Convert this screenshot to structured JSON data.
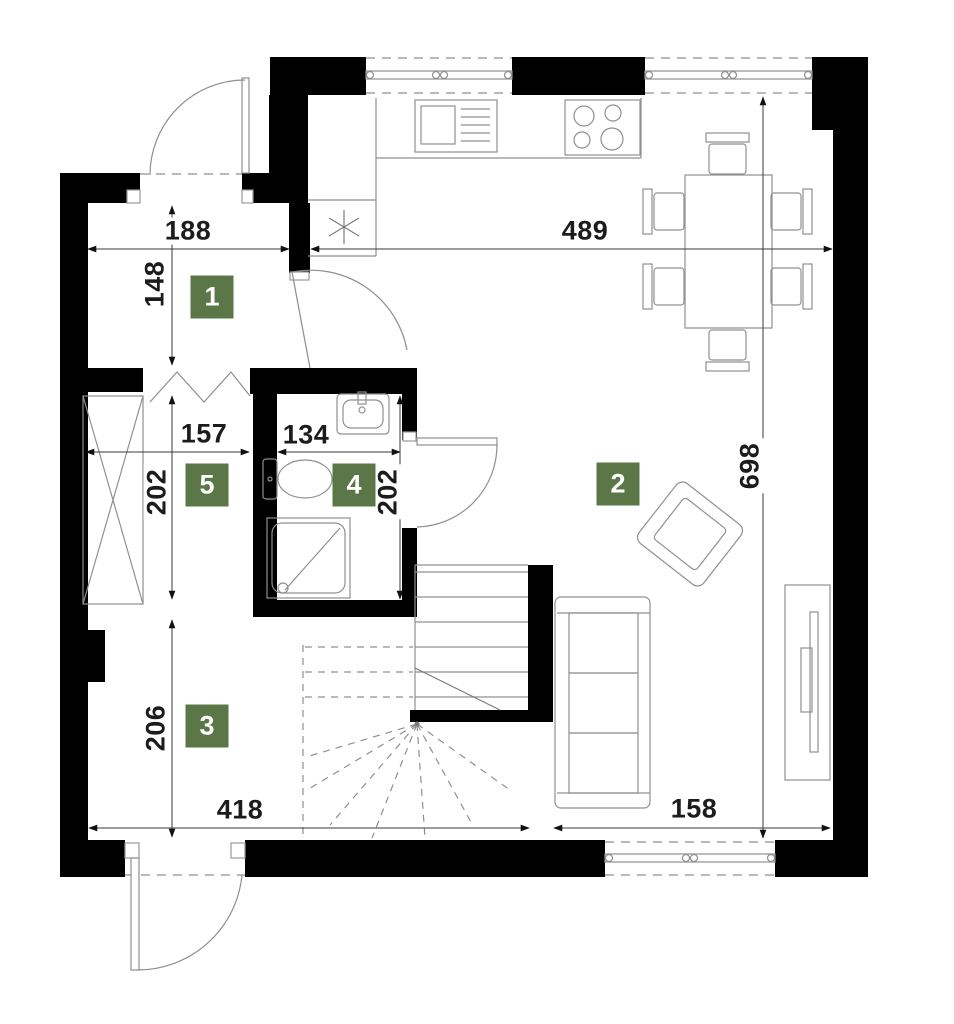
{
  "plan": {
    "type": "apartment-floor-plan",
    "colors": {
      "background": "#ffffff",
      "wall": "#000000",
      "furniture_line": "#909090",
      "dimension_line": "#3a3a3a",
      "dimension_text": "#1c1c1c",
      "badge_bg": "#5b7747",
      "badge_text": "#ffffff"
    },
    "rooms": [
      {
        "id": "room-1",
        "label": "1"
      },
      {
        "id": "room-2",
        "label": "2"
      },
      {
        "id": "room-3",
        "label": "3"
      },
      {
        "id": "room-4",
        "label": "4"
      },
      {
        "id": "room-5",
        "label": "5"
      }
    ],
    "dimensions": [
      {
        "id": "room1-width",
        "value": "188",
        "orientation": "h"
      },
      {
        "id": "room1-height",
        "value": "148",
        "orientation": "v"
      },
      {
        "id": "kitchen-width",
        "value": "489",
        "orientation": "h"
      },
      {
        "id": "living-height",
        "value": "698",
        "orientation": "v"
      },
      {
        "id": "room5-width",
        "value": "157",
        "orientation": "h"
      },
      {
        "id": "bathroom-width",
        "value": "134",
        "orientation": "h"
      },
      {
        "id": "room5-height",
        "value": "202",
        "orientation": "v"
      },
      {
        "id": "bathroom-height",
        "value": "202",
        "orientation": "v"
      },
      {
        "id": "room3-height",
        "value": "206",
        "orientation": "v"
      },
      {
        "id": "room3-width",
        "value": "418",
        "orientation": "h"
      },
      {
        "id": "living-window",
        "value": "158",
        "orientation": "h"
      }
    ],
    "symbols": {
      "boiler": "asterisk-star"
    }
  }
}
